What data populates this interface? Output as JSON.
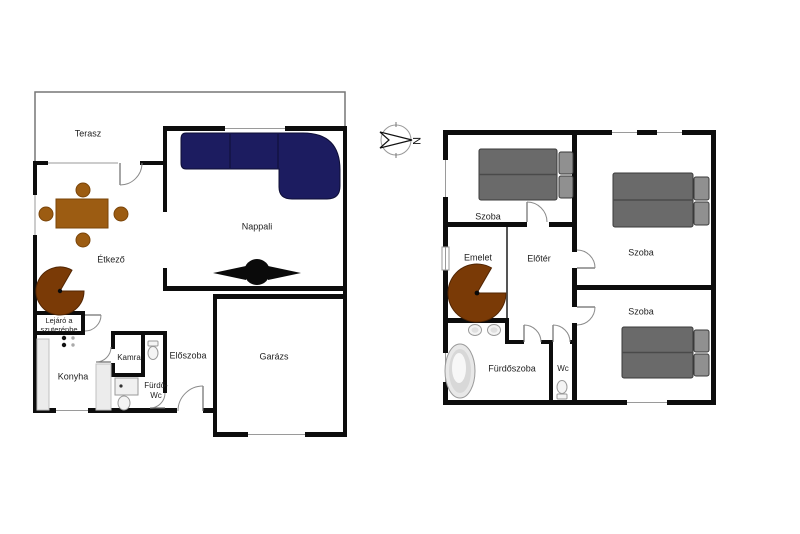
{
  "compass": {
    "north_label": "N"
  },
  "ground_floor": {
    "terrace": "Terasz",
    "living_room": "Nappali",
    "dining_room": "Étkező",
    "basement_stairs_line1": "Lejáró a",
    "basement_stairs_line2": "szuterénbe",
    "kitchen": "Konyha",
    "pantry": "Kamra",
    "bath_wc_line1": "Fürdő-",
    "bath_wc_line2": "Wc",
    "hallway": "Előszoba",
    "garage": "Garázs"
  },
  "upper_floor": {
    "bedroom_1": "Szoba",
    "bedroom_2": "Szoba",
    "bedroom_3": "Szoba",
    "landing": "Emelet",
    "foyer": "Előtér",
    "bathroom": "Fürdőszoba",
    "wc": "Wc"
  },
  "colors": {
    "wall": "#0d0d0d",
    "sofa_navy": "#1c1c60",
    "wood_brown": "#9c5c12",
    "stair_brown": "#7a3a06",
    "bed_gray": "#6a6a6a",
    "pillow_gray": "#909090",
    "counter_gray": "#ececec"
  }
}
